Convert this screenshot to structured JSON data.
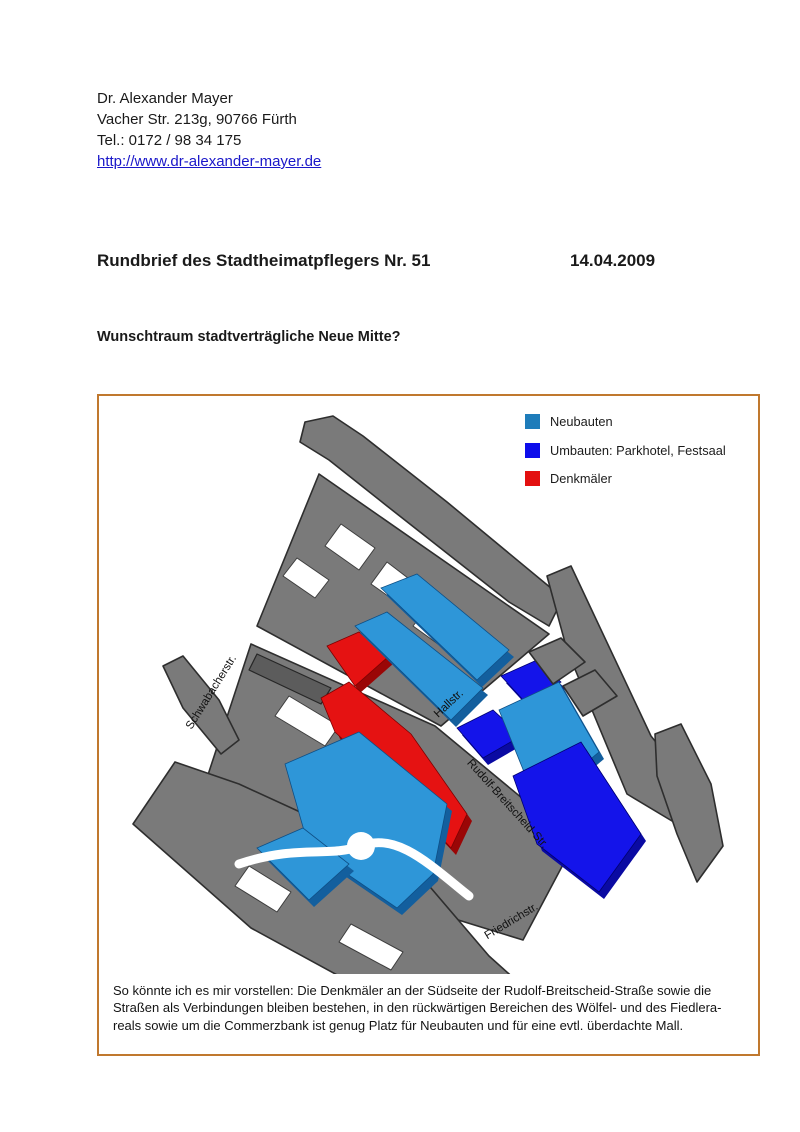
{
  "page": {
    "sender": {
      "name": "Dr. Alexander Mayer",
      "address": "Vacher Str. 213g, 90766 Fürth",
      "phone": "Tel.: 0172 / 98 34 175",
      "website": "http://www.dr-alexander-mayer.de"
    },
    "title": "Rundbrief des Stadtheimatpflegers Nr. 51",
    "date": "14.04.2009",
    "subtitle": "Wunschtraum stadtverträgliche Neue Mitte?"
  },
  "figure": {
    "frame_color": "#c0782e",
    "legend": [
      {
        "label": "Neubauten",
        "color": "#1e7cba"
      },
      {
        "label": "Umbauten: Parkhotel, Festsaal",
        "color": "#0d0deb"
      },
      {
        "label": "Denkmäler",
        "color": "#e31010"
      }
    ],
    "street_labels": {
      "schwabacher": "Schwabacherstr.",
      "hall": "Hallstr.",
      "rudolf": "Rudolf-Breitscheid-Str.",
      "friedrich": "Friedrichstr."
    },
    "caption_lines": [
      "So könnte ich es mir vorstellen: Die Denkmäler an der Südseite der Rudolf-Breitscheid-Straße sowie die",
      "Straßen als Verbindungen bleiben bestehen, in den rückwärtigen Bereichen des Wölfel- und des Fiedlera-",
      "reals sowie um die Commerzbank ist genug Platz für Neubauten und für eine evtl. überdachte Mall."
    ]
  },
  "colors": {
    "neubauten_top": "#2e96d8",
    "neubauten_side": "#135f9e",
    "umbauten_top": "#1414ea",
    "umbauten_side": "#0a0aa2",
    "denkmal_top": "#e51212",
    "denkmal_side": "#9a0606",
    "building_grey": "#7a7a7a",
    "link_blue": "#1a17c9"
  }
}
